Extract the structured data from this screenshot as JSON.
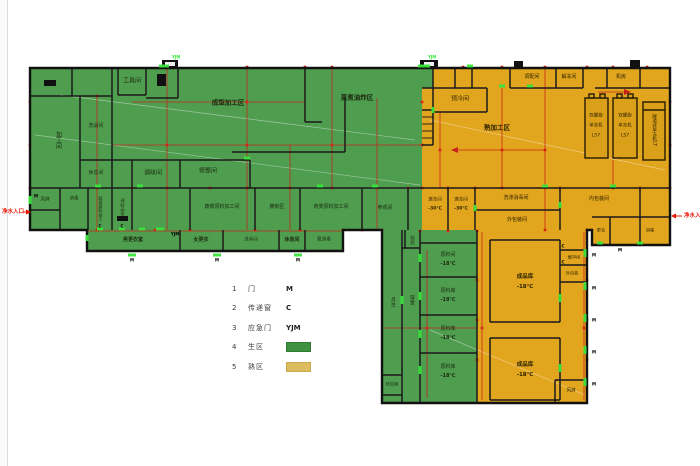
{
  "legend": {
    "items": [
      {
        "num": "1",
        "label": "门",
        "code": "M"
      },
      {
        "num": "2",
        "label": "传递窗",
        "code": "C"
      },
      {
        "num": "3",
        "label": "应急门",
        "code": "YJM"
      },
      {
        "num": "4",
        "label": "生区",
        "code": ""
      },
      {
        "num": "5",
        "label": "熟区",
        "code": ""
      }
    ]
  },
  "entrances": {
    "left": "净水入口",
    "right": "净水入口"
  },
  "markers": {
    "door": "M",
    "window": "C",
    "emergency": "YJM"
  },
  "zone_colors": {
    "raw": "#4f9d4f",
    "cooked": "#e2a51e",
    "raw_legend": "#3f9142",
    "cooked_legend": "#dcbc5e",
    "grid_red": "#c8221a",
    "wall": "#1a1a1a"
  },
  "rooms": {
    "tools": "工具间",
    "wash": "洗消间",
    "processing": "加工间",
    "rest1": "休息间",
    "seasoning": "调味间",
    "trimming": "修整间",
    "forming": "成型加工区",
    "boiling": "蒸煮油炸区",
    "veg_raw": "蔬菜原料加工间",
    "pickling": "腌制区",
    "meat_raw": "肉类原料加工间",
    "visitor": "参观间",
    "disinfect1": "消毒",
    "airshower1": "风淋",
    "veg_feed": "蔬菜原料投入",
    "season_feed": "调味品投入",
    "dress_m": "男更衣室",
    "dress_f": "女更衣",
    "washroom": "洗手间",
    "rest2": "休息间",
    "boot": "靴消毒",
    "precool": "预冷间",
    "mixing": "调配间",
    "thaw": "解冻间",
    "machineroom": "机房",
    "cooked_area": "熟加工区",
    "spiral": {
      "l1": "双螺旋",
      "l2": "单冻机",
      "l3": "LS7"
    },
    "tunnel": "隧道式单冻机LT",
    "quickfreeze": "速冻间",
    "temp_30": "-30℃",
    "washdisinfect": "洗涤消毒间",
    "outerpack": "外包装间",
    "innerpack": "内包装间",
    "dress3": "更衣",
    "disinfect2": "消毒",
    "buffer": "缓冲间",
    "outerpack2": "外包装",
    "airshower2": "风淋",
    "inspect": "检验",
    "platform": "月台",
    "hall": "穿堂",
    "raw_room": "原料间",
    "raw_store": "原料库",
    "temp_18": "-18℃",
    "heatx": "热交换",
    "product_store": "成品库"
  }
}
